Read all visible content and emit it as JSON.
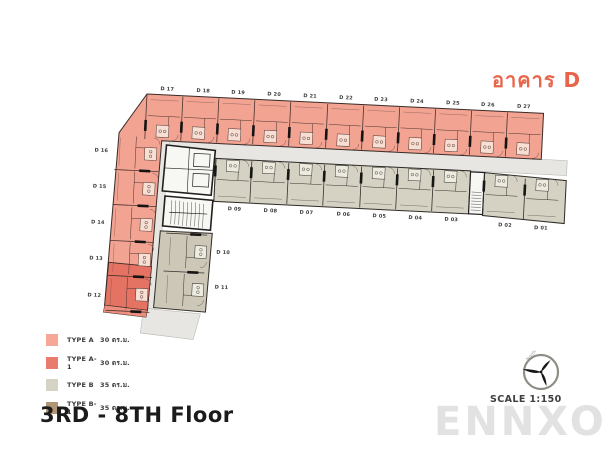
{
  "header": {
    "building_title": "อาคาร D",
    "title_color": "#E8654A"
  },
  "plan": {
    "top_units": [
      "D 17",
      "D 18",
      "D 19",
      "D 20",
      "D 21",
      "D 22",
      "D 23",
      "D 24",
      "D 25",
      "D 26",
      "D 27"
    ],
    "left_units": [
      "D 16",
      "D 15",
      "D 14",
      "D 13",
      "D 12"
    ],
    "bottom_units": [
      "D 09",
      "D 08",
      "D 07",
      "D 06",
      "D 05",
      "D 04",
      "D 03"
    ],
    "right_units": [
      "D 02",
      "D 01"
    ],
    "mid_units": [
      "D 10",
      "D 11"
    ],
    "colors": {
      "type_a": "#F2A392",
      "type_a1": "#E57363",
      "type_b": "#D5D2C4",
      "type_b1": "#B29576",
      "mid_block": "#CDC7B7",
      "corridor": "#E7E6E3",
      "core": "#F7F7F4",
      "wall": "#3A2A26"
    }
  },
  "legend": {
    "items": [
      {
        "type_label": "TYPE A",
        "area_label": "30 ตร.ม.",
        "color": "#F6A795"
      },
      {
        "type_label": "TYPE A-1",
        "area_label": "30 ตร.ม.",
        "color": "#E87A6E"
      },
      {
        "type_label": "TYPE B",
        "area_label": "35 ตร.ม.",
        "color": "#D4D3C6"
      },
      {
        "type_label": "TYPE B-1",
        "area_label": "35 ตร.ม.",
        "color": "#B29576"
      }
    ]
  },
  "footer": {
    "floor_label": "3RD - 8TH Floor"
  },
  "compass": {
    "north_label": "North",
    "scale_label": "SCALE 1:150"
  },
  "watermark": "ENNXO"
}
